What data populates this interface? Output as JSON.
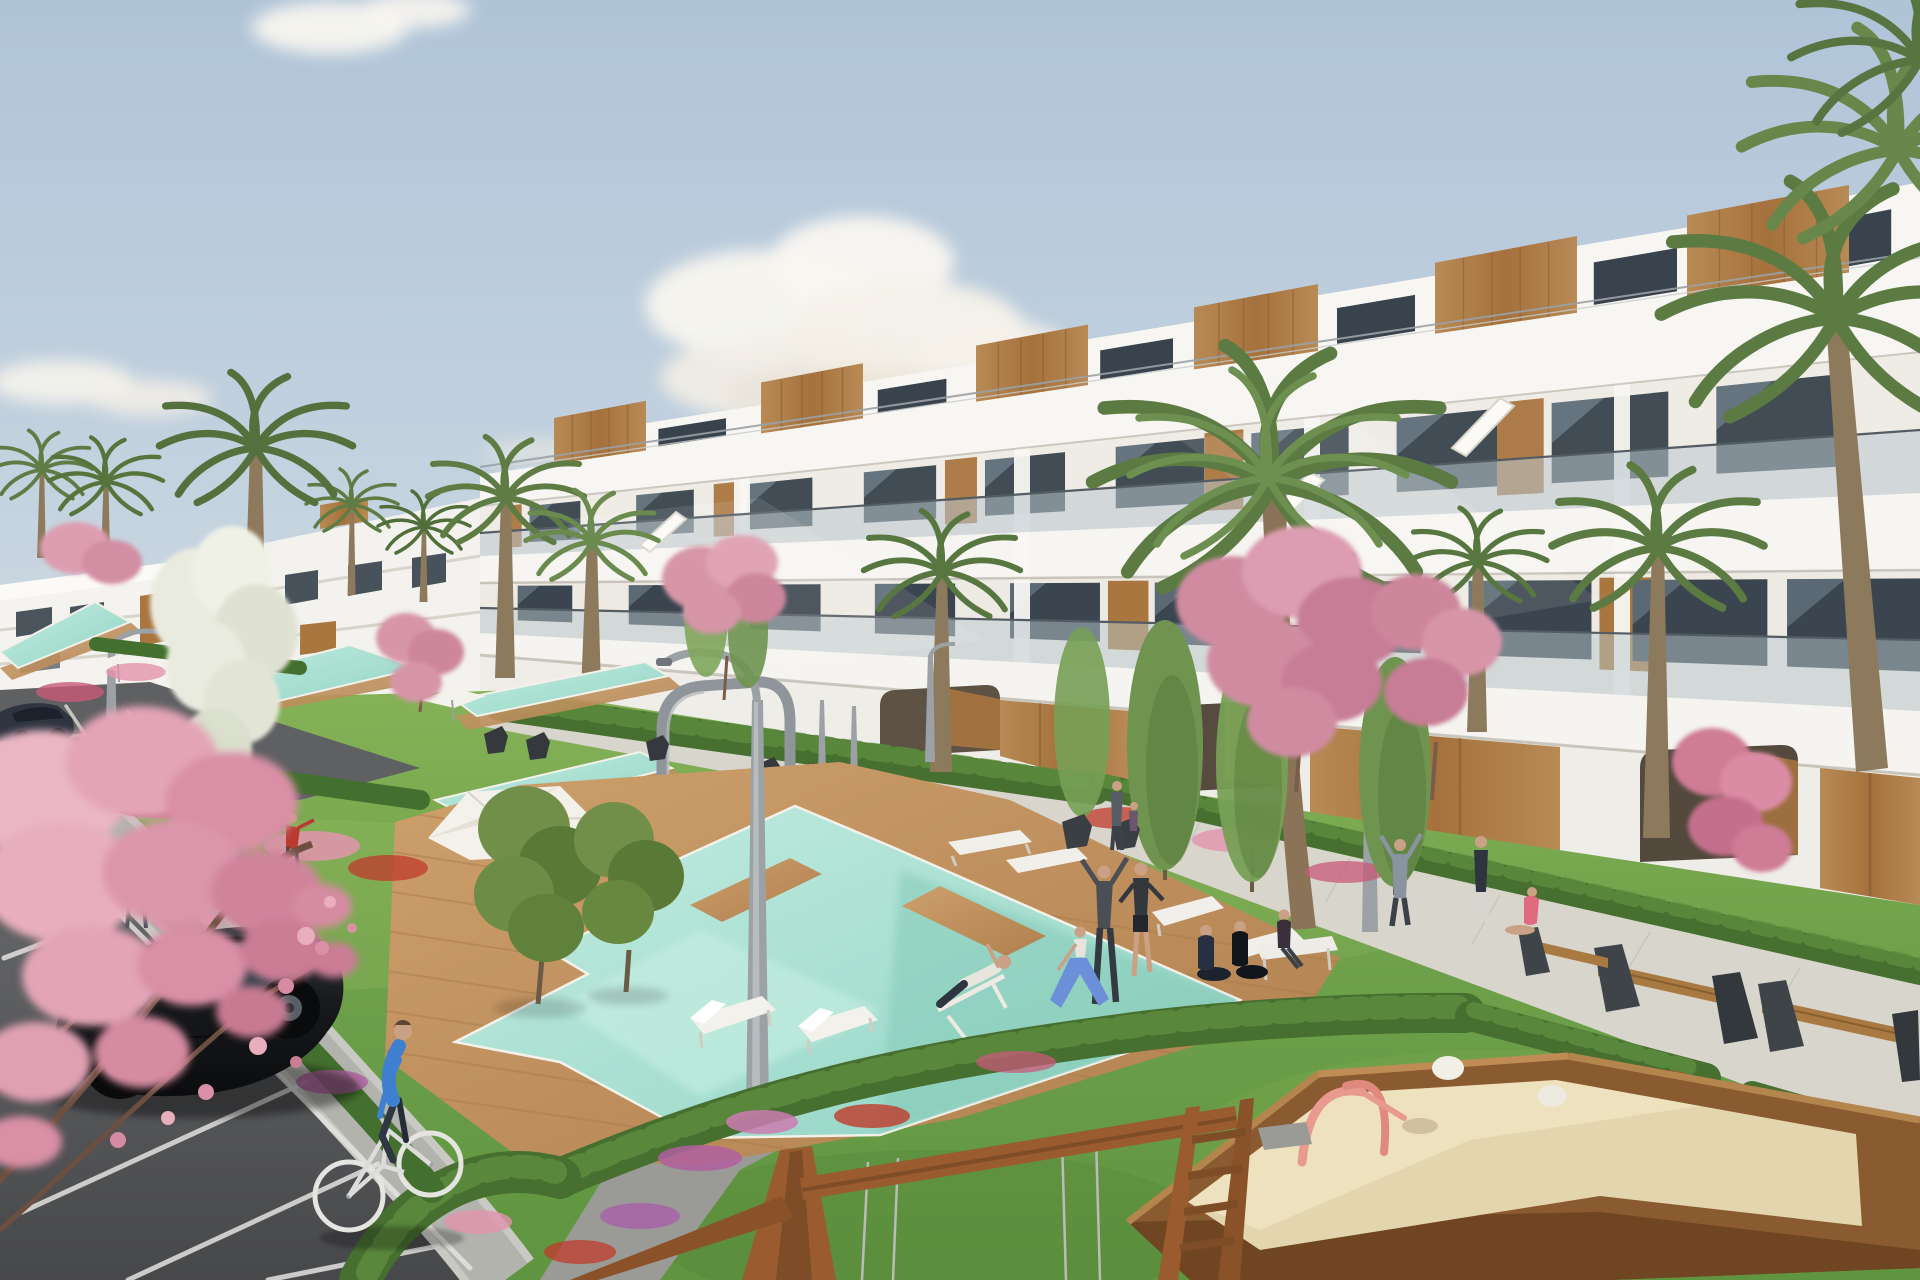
{
  "scene": {
    "domain": "natural-image",
    "type": "3d-architectural-rendering",
    "description": "Sunny daytime 3D render of a modern white terraced apartment complex with wood-clad rooftop penthouses and glass balconies. Landscaped communal gardens hold a chain of turquoise swimming pools with wooden decks, white sun loungers and a parasol, palm trees, pink blossom trees, flower beds and hedges. Residents stretch and exercise on the lawns, a man cycles past a black hatchback parked in the foreground parking lot, and a wooden swing frame and sandbox playground with pink toys sit in the bottom-right lawn beside a bench-lined walkway. Pale blue sky with soft scattered clouds.",
    "time_of_day": "day",
    "weather": "sunny with scattered clouds",
    "palette": {
      "sky_top": "#b0c4d8",
      "sky_horizon": "#ece9df",
      "cloud_white": "#f8f5ef",
      "building_white": "#f5f4f0",
      "building_shade": "#d9d5cc",
      "wood_panel": "#b0804c",
      "window_glass": "#414c55",
      "balustrade_glass": "#b9c7cd",
      "palm_green": "#5b7b42",
      "grass_green": "#74a44c",
      "hedge_green": "#466f30",
      "pool_turquoise": "#a5ded0",
      "deck_wood": "#c49663",
      "walkway_concrete": "#d8d5cd",
      "path_gray": "#b7b7b2",
      "asphalt_gray": "#57585a",
      "blossom_pink": "#e6a8b8",
      "white_blossom": "#e9ebdf",
      "sand_beige": "#e3d5ae",
      "swing_wood": "#9a5c2e",
      "car_black": "#17191c",
      "cyclist_shirt_blue": "#3f7fd0",
      "flower_red": "#c0392b",
      "flower_purple": "#b05fa0",
      "flower_pink": "#e394ae"
    },
    "elements": {
      "apartment_blocks": 3,
      "rooftop_wood_boxes": 7,
      "swimming_pools": 5,
      "palm_trees": 11,
      "blossom_trees": 7,
      "white_flower_trees": 1,
      "columnar_trees": 6,
      "olive_trees": 2,
      "people": 17,
      "cars": 3,
      "bicycles": 1,
      "street_lamps": 4,
      "sun_loungers": 8,
      "benches": 4,
      "parasols": 3,
      "pergola_arches": 1,
      "sandboxes": 1,
      "swing_frames": 1
    }
  }
}
